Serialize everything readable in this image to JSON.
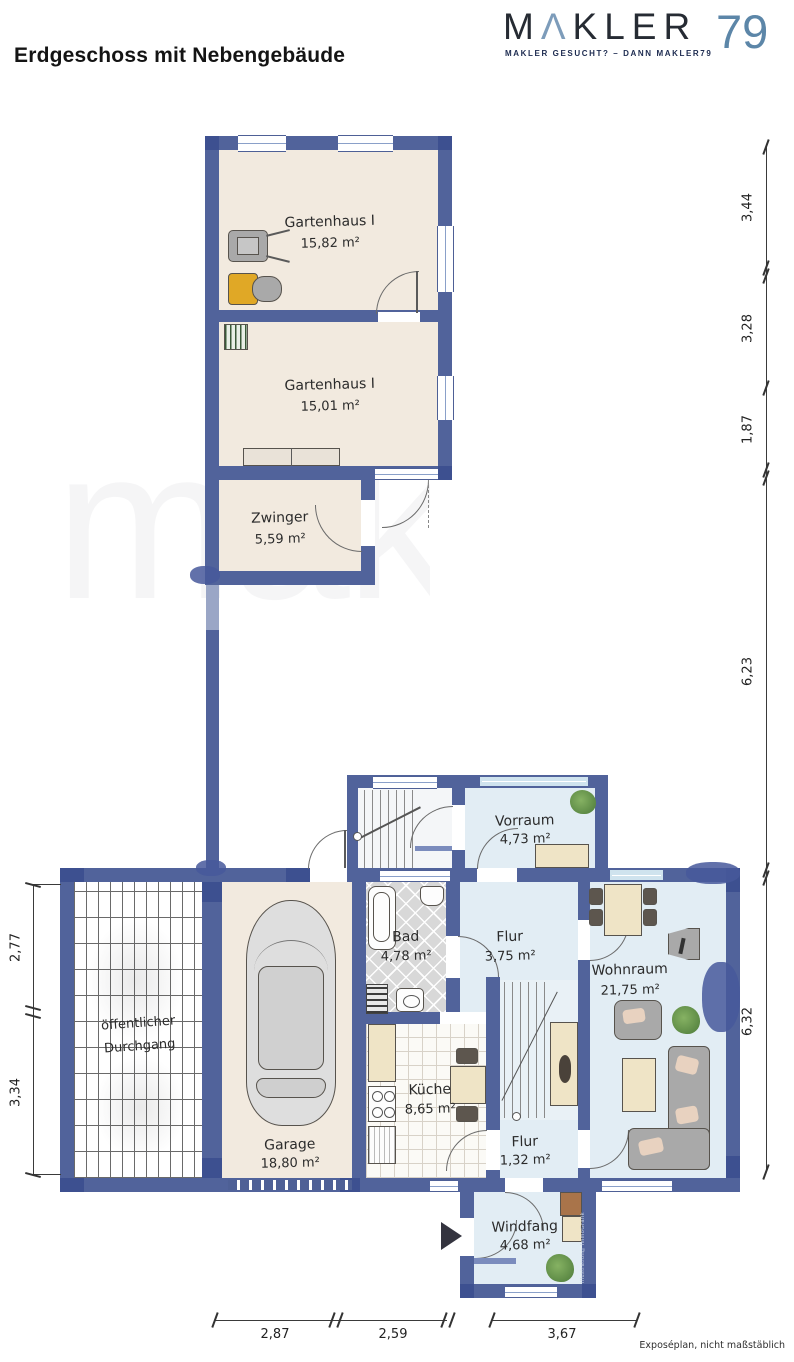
{
  "header": {
    "title": "Erdgeschoss mit Nebengebäude"
  },
  "logo": {
    "m": "M",
    "a": "Λ",
    "kler": "KLER",
    "number": "79",
    "tagline": "MAKLER GESUCHT? – DANN MAKLER79",
    "color_dark": "#262b33",
    "color_blue": "#5c86a8"
  },
  "rooms": [
    {
      "id": "gartenhaus-1",
      "name": "Gartenhaus I",
      "area": "15,82 m²"
    },
    {
      "id": "gartenhaus-2",
      "name": "Gartenhaus I",
      "area": "15,01 m²"
    },
    {
      "id": "zwinger",
      "name": "Zwinger",
      "area": "5,59 m²"
    },
    {
      "id": "vorraum",
      "name": "Vorraum",
      "area": "4,73 m²"
    },
    {
      "id": "bad",
      "name": "Bad",
      "area": "4,78 m²"
    },
    {
      "id": "flur",
      "name": "Flur",
      "area": "3,75 m²"
    },
    {
      "id": "wohnraum",
      "name": "Wohnraum",
      "area": "21,75 m²"
    },
    {
      "id": "kueche",
      "name": "Küche",
      "area": "8,65 m²"
    },
    {
      "id": "flur-klein",
      "name": "Flur",
      "area": "1,32 m²"
    },
    {
      "id": "garage",
      "name": "Garage",
      "area": "18,80 m²"
    },
    {
      "id": "windfang",
      "name": "Windfang",
      "area": "4,68 m²"
    }
  ],
  "passage": {
    "line1": "öffentlicher",
    "line2": "Durchgang"
  },
  "dimensions": {
    "right": [
      "3,44",
      "3,28",
      "1,87",
      "6,23",
      "6,32"
    ],
    "left": [
      "2,77",
      "3,34"
    ],
    "bottom": [
      "2,87",
      "2,59",
      "3,67"
    ]
  },
  "footnote": "Exposéplan, nicht maßstäblich",
  "credit": "Illustration©ImmoGrafik",
  "watermark": "makler",
  "colors": {
    "wall": "#51639b",
    "wall_dark": "#3d5090",
    "floor_beige": "#f2eadf",
    "floor_blue": "#e2edf4",
    "tile_gray": "#d8d8d8",
    "tile_white": "#fbfaf6"
  }
}
